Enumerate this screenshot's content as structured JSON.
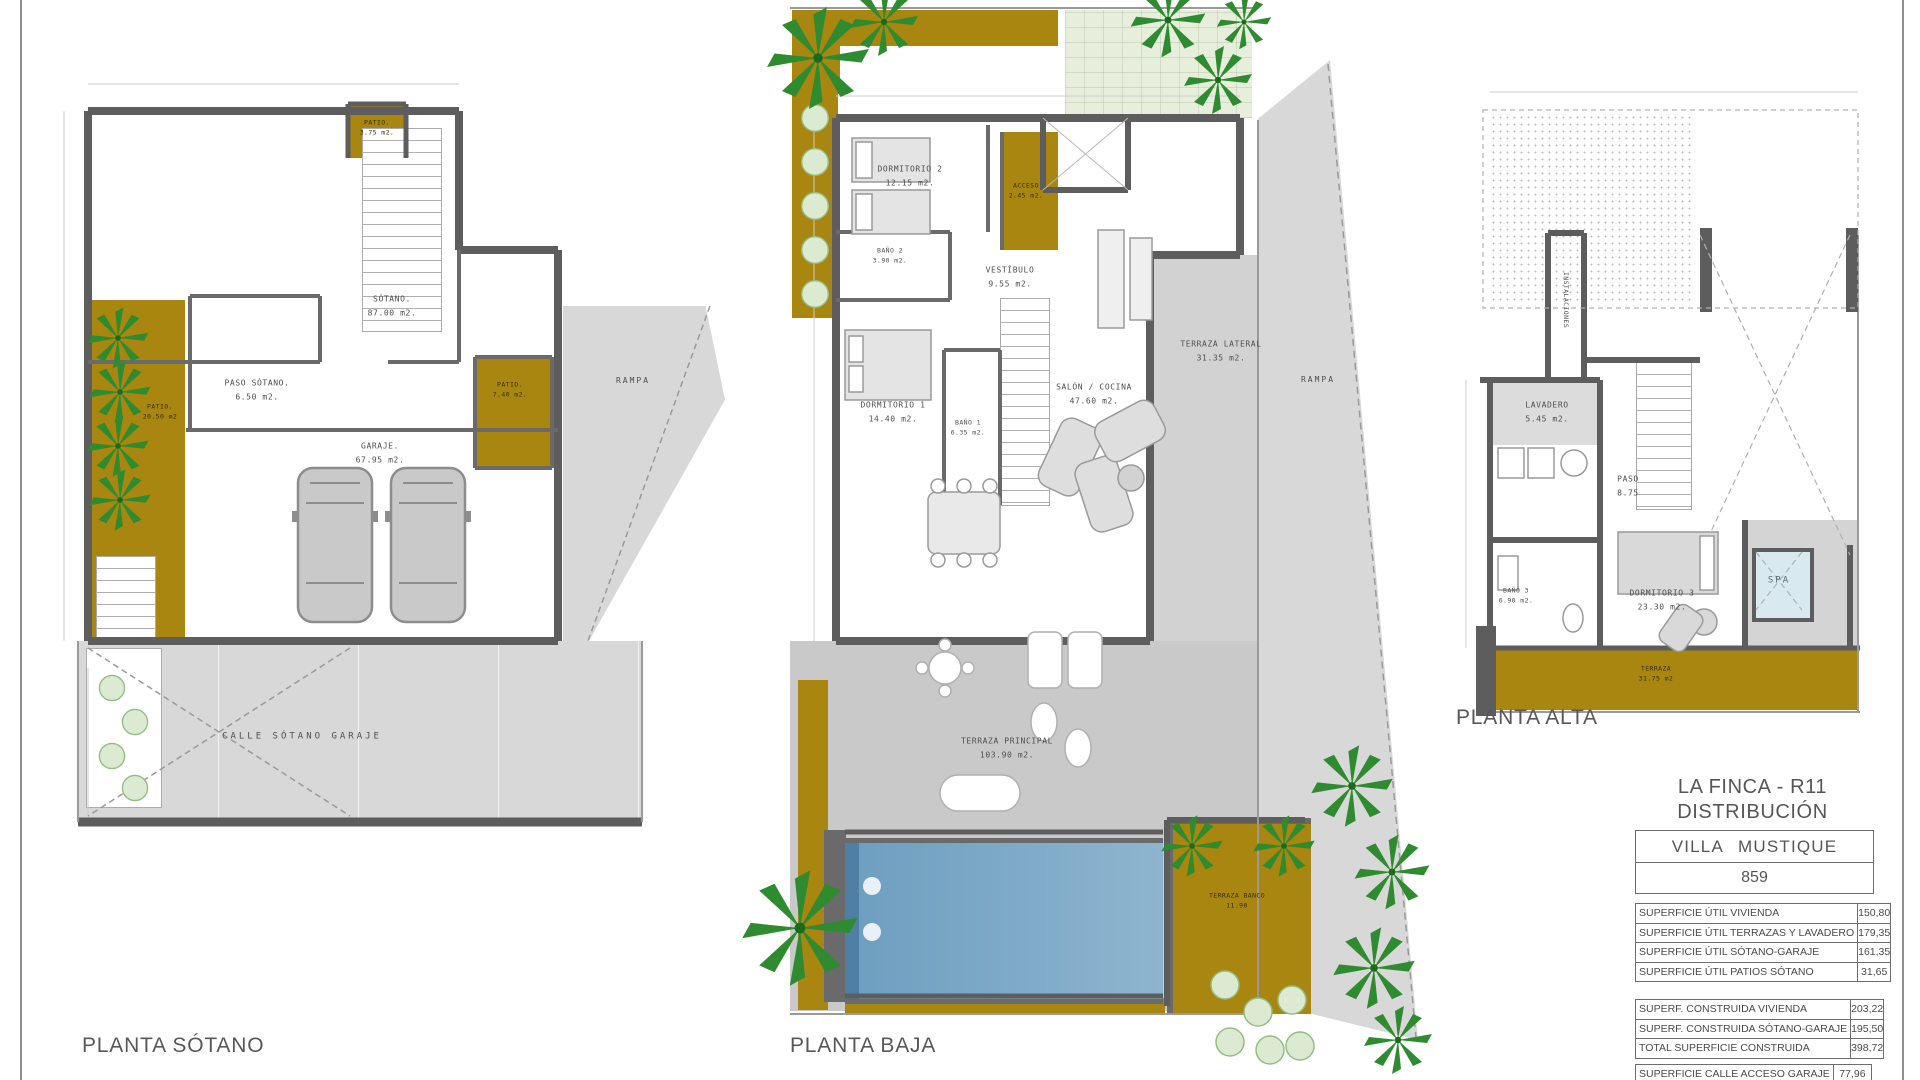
{
  "colors": {
    "ochre": "#a8860f",
    "wall_gray": "#5d5d5d",
    "paving_gray": "#c9c9c9",
    "pool_blue": "#6f9fc0",
    "spa_blue": "#d9e9f0",
    "palm_green": "#2f8b2f",
    "bush_green": "#dcead2"
  },
  "plans": {
    "sotano": {
      "title": "PLANTA SÓTANO",
      "rooms": {
        "sotano": {
          "name": "SÓTANO.",
          "area": "87.00 m2."
        },
        "paso": {
          "name": "PASO SÓTANO.",
          "area": "6.50 m2."
        },
        "garaje": {
          "name": "GARAJE.",
          "area": "67.95 m2."
        },
        "patio_izq": {
          "name": "PATIO.",
          "area": "20.50 m2"
        },
        "patio_der": {
          "name": "PATIO.",
          "area": "7.40 m2."
        },
        "patio_sup": {
          "name": "PATIO.",
          "area": "3.75 m2."
        },
        "rampa": {
          "name": "RAMPA"
        },
        "calle": {
          "name": "CALLE SÓTANO GARAJE"
        }
      }
    },
    "baja": {
      "title": "PLANTA BAJA",
      "rooms": {
        "dormitorio2": {
          "name": "DORMITORIO 2",
          "area": "12.15 m2."
        },
        "bano2": {
          "name": "BAÑO 2",
          "area": "3.90 m2."
        },
        "vestibulo": {
          "name": "VESTÍBULO",
          "area": "9.55 m2."
        },
        "acceso": {
          "name": "ACCESO",
          "area": "2.45 m2."
        },
        "dormitorio1": {
          "name": "DORMITORIO 1",
          "area": "14.40 m2."
        },
        "bano1": {
          "name": "BAÑO 1",
          "area": "6.35 m2."
        },
        "salon": {
          "name": "SALÓN / COCINA",
          "area": "47.60 m2."
        },
        "terraza_lateral": {
          "name": "TERRAZA LATERAL",
          "area": "31.35 m2."
        },
        "rampa": {
          "name": "RAMPA"
        },
        "terraza_principal": {
          "name": "TERRAZA PRINCIPAL",
          "area": "103.90 m2."
        },
        "terraza_banco": {
          "name": "TERRAZA BANCO",
          "area": "11.90"
        }
      }
    },
    "alta": {
      "title": "PLANTA ALTA",
      "rooms": {
        "instalaciones": {
          "name": "INSTALACIONES"
        },
        "lavadero": {
          "name": "LAVADERO",
          "area": "5.45 m2."
        },
        "paso": {
          "name": "PASO",
          "area": "8.75"
        },
        "bano3": {
          "name": "BAÑO 3",
          "area": "6.90 m2."
        },
        "dormitorio3": {
          "name": "DORMITORIO 3",
          "area": "23.30 m2."
        },
        "spa": {
          "name": "SPA"
        },
        "terraza": {
          "name": "TERRAZA",
          "area": "31.75 m2"
        }
      }
    }
  },
  "titleblock": {
    "project": "LA FINCA - R11",
    "drawing": "DISTRIBUCIÓN",
    "villa": "VILLA MUSTIQUE",
    "plot": "859",
    "useful_areas": [
      {
        "label": "SUPERFICIE ÚTIL VIVIENDA",
        "value": "150,80"
      },
      {
        "label": "SUPERFICIE ÚTIL TERRAZAS Y LAVADERO",
        "value": "179,35"
      },
      {
        "label": "SUPERFICIE ÚTIL SÓTANO-GARAJE",
        "value": "161,35"
      },
      {
        "label": "SUPERFICIE ÚTIL PATIOS SÓTANO",
        "value": "31,65"
      }
    ],
    "built_areas": [
      {
        "label": "SUPERF. CONSTRUIDA VIVIENDA",
        "value": "203,22"
      },
      {
        "label": "SUPERF. CONSTRUIDA SÓTANO-GARAJE",
        "value": "195,50"
      },
      {
        "label": "TOTAL SUPERFICIE CONSTRUIDA",
        "value": "398,72"
      }
    ],
    "access_areas": [
      {
        "label": "SUPERFICIE CALLE ACCESO GARAJE",
        "value": "77,96"
      }
    ]
  }
}
